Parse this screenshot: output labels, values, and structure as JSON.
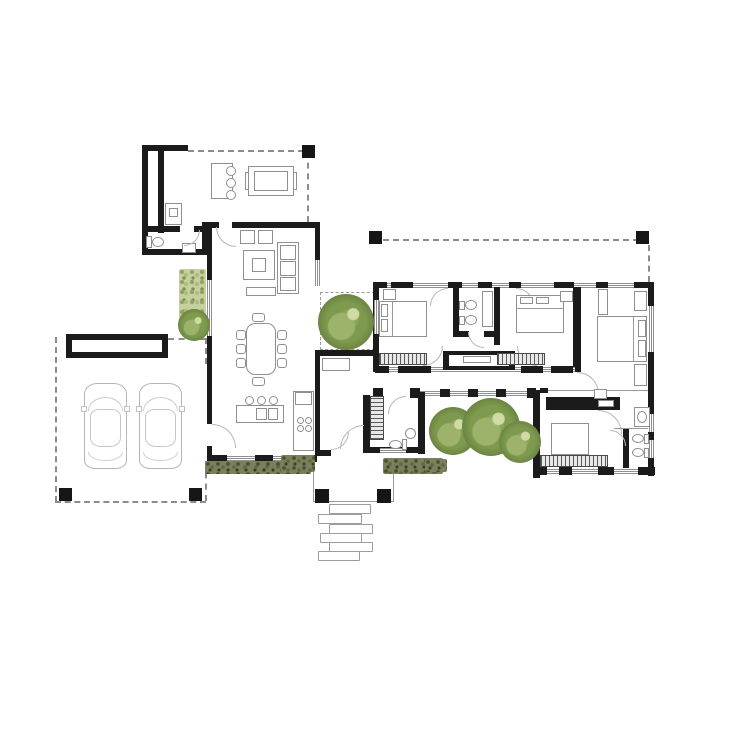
{
  "meta": {
    "type": "architectural-floor-plan",
    "canvas": {
      "width": 736,
      "height": 736
    },
    "background": "#ffffff",
    "visible_text": ""
  },
  "palette": {
    "wall": "#1b1b1b",
    "thin_line": "#9a9a9a",
    "furniture_border": "#8f8f8f",
    "hatch_dark": "#4a4a4a",
    "tree_dark": "#5a7334",
    "tree_mid": "#7d9a4e",
    "tree_light": "#cfdba2",
    "hedge_dark": "#4a5331",
    "hedge_base": "#79805d",
    "hedge_light": "#c6d09c",
    "car_line": "#b5b5b5",
    "stone_border": "#9c9c9c"
  },
  "rooms": [
    {
      "name": "garage-carport"
    },
    {
      "name": "laundry-utility"
    },
    {
      "name": "utility-wc"
    },
    {
      "name": "outdoor-terrace-bbq"
    },
    {
      "name": "living-room"
    },
    {
      "name": "dining-area"
    },
    {
      "name": "kitchen"
    },
    {
      "name": "entry-vestibule"
    },
    {
      "name": "powder-room"
    },
    {
      "name": "tree-courtyard-west"
    },
    {
      "name": "glazed-corridor"
    },
    {
      "name": "bedroom-1"
    },
    {
      "name": "shared-bathroom"
    },
    {
      "name": "bedroom-2"
    },
    {
      "name": "master-bedroom"
    },
    {
      "name": "tree-courtyard-south"
    },
    {
      "name": "guest-room-office"
    },
    {
      "name": "guest-bathroom"
    },
    {
      "name": "entry-porch"
    },
    {
      "name": "stepping-stone-path"
    }
  ],
  "elements": {
    "trees": [
      {
        "x": 178,
        "y": 309,
        "d": 32
      },
      {
        "x": 318,
        "y": 294,
        "d": 56
      },
      {
        "x": 429,
        "y": 407,
        "d": 48
      },
      {
        "x": 462,
        "y": 398,
        "d": 58
      },
      {
        "x": 499,
        "y": 421,
        "d": 42
      }
    ],
    "hedges": [
      {
        "x": 205,
        "y": 461,
        "w": 106,
        "h": 13,
        "v": "dark"
      },
      {
        "x": 281,
        "y": 455,
        "w": 34,
        "h": 17,
        "v": "dark"
      },
      {
        "x": 383,
        "y": 458,
        "w": 60,
        "h": 16,
        "v": "dark"
      },
      {
        "x": 425,
        "y": 459,
        "w": 22,
        "h": 13,
        "v": "dark"
      },
      {
        "x": 179,
        "y": 269,
        "w": 27,
        "h": 63,
        "v": "light"
      }
    ],
    "stepping_stones": [
      {
        "x": 329,
        "y": 504,
        "w": 40,
        "h": 8
      },
      {
        "x": 318,
        "y": 514,
        "w": 42,
        "h": 8
      },
      {
        "x": 329,
        "y": 524,
        "w": 42,
        "h": 8
      },
      {
        "x": 320,
        "y": 533,
        "w": 40,
        "h": 8
      },
      {
        "x": 329,
        "y": 542,
        "w": 42,
        "h": 8
      },
      {
        "x": 318,
        "y": 551,
        "w": 40,
        "h": 8
      }
    ],
    "posts": [
      {
        "x": 302,
        "y": 145,
        "s": 13
      },
      {
        "x": 369,
        "y": 231,
        "s": 13
      },
      {
        "x": 636,
        "y": 231,
        "s": 13
      },
      {
        "x": 59,
        "y": 488,
        "s": 13
      },
      {
        "x": 189,
        "y": 488,
        "s": 13
      },
      {
        "x": 315,
        "y": 489,
        "s": 14
      },
      {
        "x": 377,
        "y": 489,
        "s": 14
      }
    ],
    "cars": [
      {
        "x": 84,
        "y": 383,
        "w": 43,
        "h": 86
      },
      {
        "x": 139,
        "y": 383,
        "w": 43,
        "h": 86
      }
    ]
  },
  "counts": {
    "cars": 2,
    "trees": 5,
    "stepping_stones": 6,
    "structural_posts": 7,
    "bedrooms": 3,
    "bathrooms": 4
  }
}
